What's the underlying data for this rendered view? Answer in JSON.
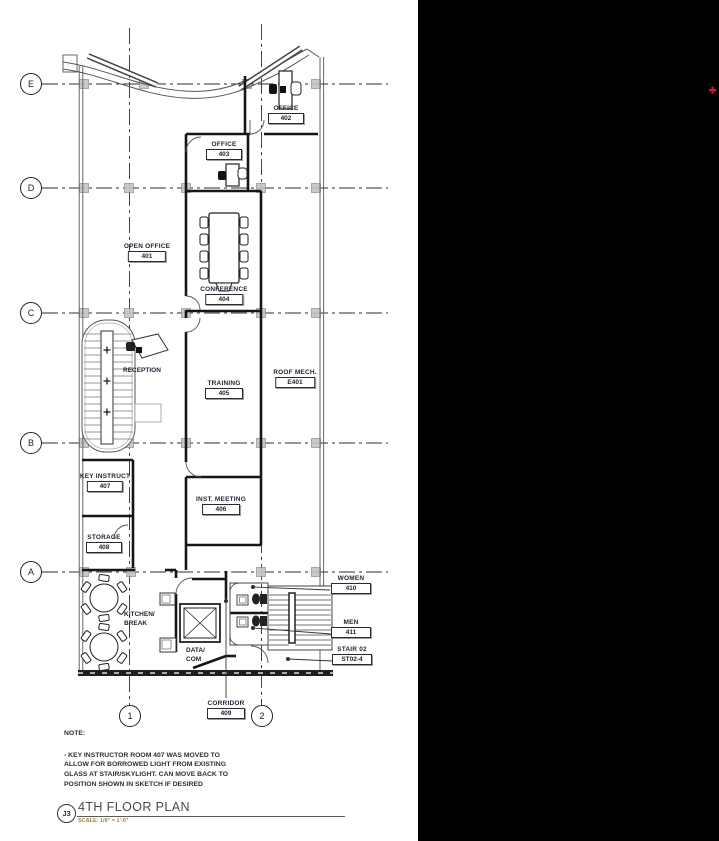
{
  "drawing": {
    "kind": "architectural floor plan"
  },
  "colors": {
    "wall": "#161616",
    "light_line": "#666666",
    "label_text": "#1c2333",
    "black_panel": "#000000",
    "red_marker": "#e8112d",
    "column_marker": "#c4c4c4"
  },
  "grid": {
    "row_bubbles": [
      "E",
      "D",
      "C",
      "B",
      "A"
    ],
    "col_bubbles": [
      "1",
      "2"
    ]
  },
  "rooms": [
    {
      "name": "OFFICE",
      "number": "402"
    },
    {
      "name": "OFFICE",
      "number": "403"
    },
    {
      "name": "OPEN OFFICE",
      "number": "401"
    },
    {
      "name": "CONFERENCE",
      "number": "404"
    },
    {
      "name": "TRAINING",
      "number": "405"
    },
    {
      "name": "ROOF MECH.",
      "number": "E401"
    },
    {
      "name": "KEY INSTRUCT",
      "number": "407"
    },
    {
      "name": "INST. MEETING",
      "number": "406"
    },
    {
      "name": "STORAGE",
      "number": "408"
    },
    {
      "name": "WOMEN",
      "number": "410"
    },
    {
      "name": "MEN",
      "number": "411"
    },
    {
      "name": "STAIR 02",
      "number": "ST02-4"
    },
    {
      "name": "CORRIDOR",
      "number": "409"
    }
  ],
  "plain_labels": {
    "reception": "RECEPTION",
    "kitchen_line1": "KITCHEN/",
    "kitchen_line2": "BREAK",
    "data_line1": "DATA/",
    "data_line2": "COM"
  },
  "note": {
    "heading": "NOTE:",
    "lines": [
      "- KEY INSTRUCTOR ROOM 407 WAS MOVED TO",
      "ALLOW FOR BORROWED LIGHT FROM EXISTING",
      "GLASS AT STAIR/SKYLIGHT.  CAN MOVE BACK TO",
      "POSITION SHOWN IN SKETCH IF DESIRED"
    ]
  },
  "title_block": {
    "detail_ref": "J3",
    "title": "4TH FLOOR PLAN",
    "scale": "SCALE: 1/8\" = 1'-0\""
  }
}
